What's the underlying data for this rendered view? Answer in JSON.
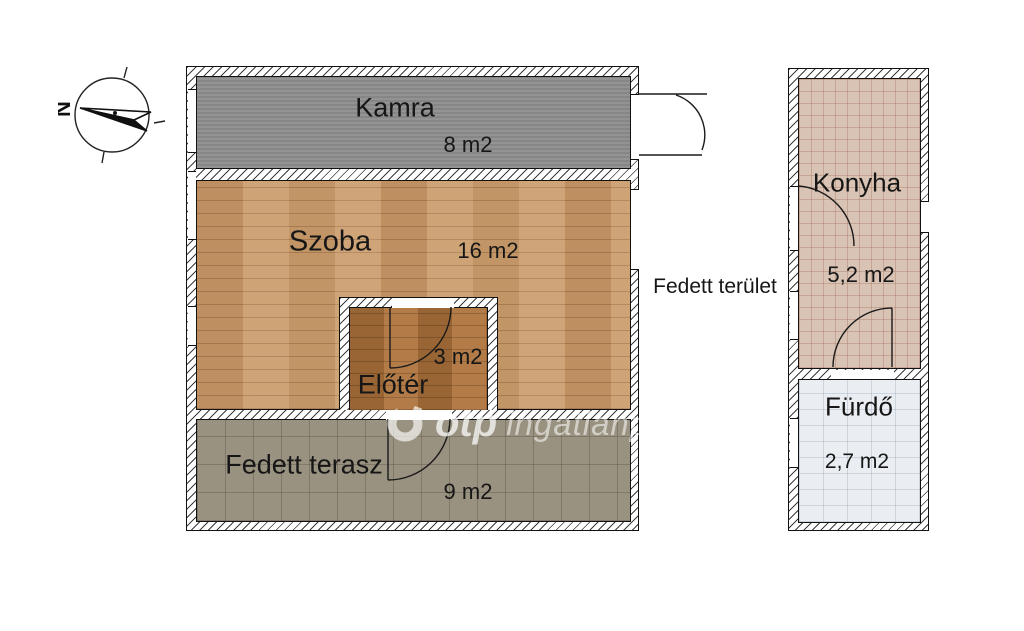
{
  "compass": {
    "north_label": "N"
  },
  "outside_area_label": "Fedett terület",
  "watermark": {
    "brand": "otp",
    "name": "ingatlanpont"
  },
  "rooms": {
    "kamra": {
      "name": "Kamra",
      "area": "8 m2"
    },
    "szoba": {
      "name": "Szoba",
      "area": "16 m2"
    },
    "eloter": {
      "name": "Előtér",
      "area": "3 m2"
    },
    "terasz": {
      "name": "Fedett terasz",
      "area": "9 m2"
    },
    "konyha": {
      "name": "Konyha",
      "area": "5,2 m2"
    },
    "furdo": {
      "name": "Fürdő",
      "area": "2,7 m2"
    }
  },
  "colors": {
    "kamra-fill": "#8d8d8d",
    "szoba-wood": "#c79a6b",
    "eloter-wood": "#a9713c",
    "terasz-tile": "#9a9280",
    "konyha-tile": "#d9c3b4",
    "furdo-tile": "#eaeef2",
    "wall-line": "#111111"
  }
}
